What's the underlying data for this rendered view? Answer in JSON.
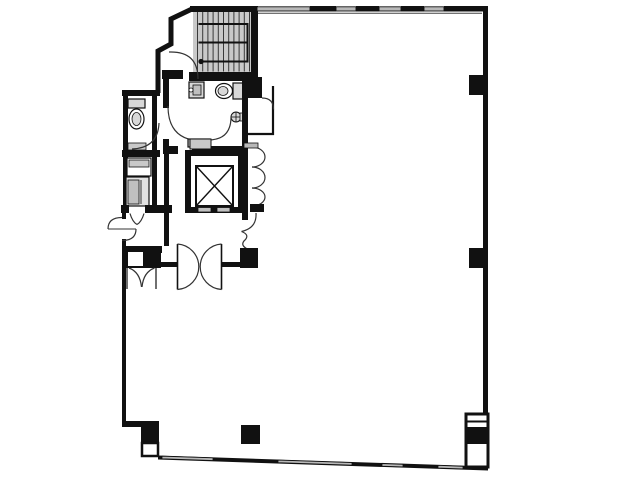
{
  "meta": {
    "type": "architectural-floor-plan",
    "canvas": {
      "width": 640,
      "height": 480
    }
  },
  "colors": {
    "wall": "#111111",
    "line": "#333333",
    "stair_fill": "#c9c9c9",
    "fixture": "#d8d8d8",
    "window": "#b8b8b8",
    "background": "#ffffff"
  },
  "plan": {
    "elements": [
      {
        "t": "rect",
        "n": "stairwell-fill",
        "x": 193,
        "y": 8,
        "w": 58,
        "h": 64,
        "f": "#c9c9c9"
      },
      {
        "t": "treads",
        "n": "stair-tread-line",
        "x0": 197.5,
        "x1": 249.5,
        "step": 5.2,
        "y0": 9,
        "y1": 71.5,
        "c": "#3a3a3a",
        "w": 1
      },
      {
        "t": "path",
        "n": "stair-flight-rail",
        "d": "M 198.5 24 H 247.5 V 61.5 H 198.5",
        "s": "#111111",
        "sw": 2
      },
      {
        "t": "line",
        "n": "stair-mid-rail",
        "x1": 198.5,
        "y1": 42.5,
        "x2": 247.5,
        "y2": 42.5,
        "s": "#111111",
        "sw": 2
      },
      {
        "t": "circle",
        "n": "stair-start-marker",
        "cx": 201,
        "cy": 61.5,
        "r": 2.6,
        "f": "#111111"
      },
      {
        "t": "rect",
        "n": "wing-top-wall",
        "x": 122,
        "y": 90,
        "w": 38,
        "h": 6
      },
      {
        "t": "rect",
        "n": "wing-left-wall",
        "x": 123,
        "y": 90,
        "w": 5,
        "h": 120
      },
      {
        "t": "rect",
        "n": "wing-right-wall",
        "x": 152,
        "y": 96,
        "w": 5,
        "h": 110
      },
      {
        "t": "rect",
        "n": "wing-divider-wall",
        "x": 122,
        "y": 150,
        "w": 38,
        "h": 7
      },
      {
        "t": "rect",
        "n": "wing-shelf",
        "x": 128,
        "y": 143,
        "w": 18,
        "h": 7,
        "f": "#c9c9c9",
        "s": "#111111",
        "sw": 0.8
      },
      {
        "t": "rect",
        "n": "wc-tank",
        "x": 128,
        "y": 99,
        "w": 17,
        "h": 9,
        "f": "#d8d8d8",
        "s": "#111111",
        "sw": 1.2
      },
      {
        "t": "ellipse",
        "n": "wc-bowl",
        "cx": 136.5,
        "cy": 119,
        "rx": 7.5,
        "ry": 10
      },
      {
        "t": "ellipse",
        "n": "wc-bowl-inner",
        "cx": 136.5,
        "cy": 119,
        "rx": 4.5,
        "ry": 6.5,
        "f": "#d8d8d8",
        "sw": 0.8
      },
      {
        "t": "path",
        "n": "wc-door-arc",
        "d": "M 132 149 Q 158 148 159 123"
      },
      {
        "t": "rect",
        "n": "duct-box-a",
        "x": 127,
        "y": 158,
        "w": 24,
        "h": 18,
        "f": "#ffffff",
        "s": "#111111",
        "sw": 1.2
      },
      {
        "t": "rect",
        "n": "duct-box-a-band",
        "x": 129,
        "y": 160,
        "w": 20,
        "h": 7,
        "f": "#c9c9c9",
        "s": "#111111",
        "sw": 0.8
      },
      {
        "t": "rect",
        "n": "duct-box-b",
        "x": 126,
        "y": 177,
        "w": 23,
        "h": 29,
        "f": "#e2e2e2",
        "s": "#111111",
        "sw": 1.2
      },
      {
        "t": "rect",
        "n": "duct-box-b-inner",
        "x": 128,
        "y": 180,
        "w": 11,
        "h": 24,
        "f": "#c0c0c0",
        "s": "#111111",
        "sw": 0.8
      },
      {
        "t": "line",
        "n": "duct-box-b-line",
        "x1": 141,
        "y1": 180,
        "x2": 141,
        "y2": 204,
        "s": "#333333",
        "sw": 1
      },
      {
        "t": "rect",
        "n": "wing-bottom-wall-left",
        "x": 121,
        "y": 205,
        "w": 8,
        "h": 8
      },
      {
        "t": "rect",
        "n": "wing-bottom-wall-right",
        "x": 145,
        "y": 205,
        "w": 27,
        "h": 8
      },
      {
        "t": "rect",
        "n": "left-wall-upper",
        "x": 122,
        "y": 210,
        "w": 4,
        "h": 9
      },
      {
        "t": "rect",
        "n": "left-wall-lower",
        "x": 122,
        "y": 239,
        "w": 4,
        "h": 186
      },
      {
        "t": "rect",
        "n": "bottom-step-wall",
        "x": 122,
        "y": 421,
        "w": 21,
        "h": 6
      },
      {
        "t": "rect",
        "n": "stair-top-wall",
        "x": 190,
        "y": 6,
        "w": 68,
        "h": 6
      },
      {
        "t": "rect",
        "n": "stair-right-wall",
        "x": 251,
        "y": 6,
        "w": 7,
        "h": 73
      },
      {
        "t": "rect",
        "n": "stair-bottom-wall-left",
        "x": 162,
        "y": 70,
        "w": 21,
        "h": 9
      },
      {
        "t": "rect",
        "n": "stair-bottom-wall-right",
        "x": 189,
        "y": 72,
        "w": 69,
        "h": 9
      },
      {
        "t": "path",
        "n": "northwest-boundary-wall",
        "d": "M 193 8.5 L 171 19 L 171 44 L 158 51 L 158 93",
        "s": "#111111",
        "sw": 5
      },
      {
        "t": "path",
        "n": "stair-door-arc",
        "d": "M 169 52 Q 198 51 198 79"
      },
      {
        "t": "rect",
        "n": "core-left-wall-upper",
        "x": 163,
        "y": 78,
        "w": 6,
        "h": 30
      },
      {
        "t": "rect",
        "n": "core-left-wall-mid",
        "x": 163,
        "y": 139,
        "w": 6,
        "h": 15
      },
      {
        "t": "rect",
        "n": "core-left-wall-lower",
        "x": 164,
        "y": 154,
        "w": 5,
        "h": 92
      },
      {
        "t": "rect",
        "n": "midwall-left",
        "x": 163,
        "y": 146,
        "w": 15,
        "h": 8
      },
      {
        "t": "rect",
        "n": "midwall-right",
        "x": 192,
        "y": 146,
        "w": 55,
        "h": 8
      },
      {
        "t": "rect",
        "n": "urinal-body",
        "x": 189,
        "y": 82,
        "w": 15,
        "h": 16,
        "f": "#d8d8d8",
        "s": "#111111",
        "sw": 1.2
      },
      {
        "t": "rect",
        "n": "urinal-inner",
        "x": 193,
        "y": 85,
        "w": 8,
        "h": 10,
        "f": "#bfbfbf",
        "s": "#111111",
        "sw": 0.8
      },
      {
        "t": "circle",
        "n": "urinal-knob",
        "cx": 191,
        "cy": 90,
        "r": 2,
        "f": "#ffffff",
        "s": "#111111",
        "sw": 0.8
      },
      {
        "t": "rect",
        "n": "toilet-tank",
        "x": 233,
        "y": 83,
        "w": 10,
        "h": 16,
        "f": "#d8d8d8",
        "s": "#111111",
        "sw": 1.2
      },
      {
        "t": "ellipse",
        "n": "toilet-bowl",
        "cx": 224,
        "cy": 91,
        "rx": 8.5,
        "ry": 7.5
      },
      {
        "t": "ellipse",
        "n": "toilet-bowl-inner",
        "cx": 223,
        "cy": 91,
        "rx": 5,
        "ry": 4.5,
        "f": "#d8d8d8",
        "sw": 0.8
      },
      {
        "t": "path",
        "n": "toilet-stall-door-arc",
        "d": "M 168 106 Q 168 141 203 141"
      },
      {
        "t": "circle",
        "n": "hand-sink",
        "cx": 236,
        "cy": 117,
        "r": 5,
        "f": "#d8d8d8",
        "s": "#111111",
        "sw": 1
      },
      {
        "t": "line",
        "n": "hand-sink-cross-h",
        "x1": 231.5,
        "y1": 117,
        "x2": 240.5,
        "y2": 117,
        "s": "#111111",
        "sw": 0.8
      },
      {
        "t": "line",
        "n": "hand-sink-cross-v",
        "x1": 236,
        "y1": 112.5,
        "x2": 236,
        "y2": 121.5,
        "s": "#111111",
        "sw": 0.8
      },
      {
        "t": "rect",
        "n": "hand-sink-mount",
        "x": 240,
        "y": 113,
        "w": 4.5,
        "h": 8,
        "f": "#d8d8d8",
        "s": "#111111",
        "sw": 0.8
      },
      {
        "t": "path",
        "n": "sink-area-door-arc",
        "d": "M 231 117 Q 231 140 208 140"
      },
      {
        "t": "rect",
        "n": "vanity-counter",
        "x": 188,
        "y": 139,
        "w": 22,
        "h": 8,
        "f": "#c9c9c9",
        "s": "#111111",
        "sw": 1.2
      },
      {
        "t": "line",
        "n": "vanity-divider",
        "x1": 199,
        "y1": 139,
        "x2": 199,
        "y2": 147,
        "s": "#111111",
        "sw": 0.8
      },
      {
        "t": "rect",
        "n": "elevator-shaft-wall",
        "x": 185,
        "y": 150,
        "w": 59,
        "h": 63
      },
      {
        "t": "rect",
        "n": "elevator-shaft-inner",
        "x": 191,
        "y": 156,
        "w": 47,
        "h": 51,
        "f": "#ffffff"
      },
      {
        "t": "rect",
        "n": "elevator-shelf",
        "x": 190,
        "y": 139,
        "w": 21,
        "h": 10,
        "f": "#c9c9c9",
        "s": "#111111",
        "sw": 1
      },
      {
        "t": "rect",
        "n": "elevator-cab-outline",
        "x": 196,
        "y": 166,
        "w": 37,
        "h": 40,
        "f": "none",
        "s": "#111111",
        "sw": 2
      },
      {
        "t": "line",
        "n": "elevator-x-1",
        "x1": 196.5,
        "y1": 166.5,
        "x2": 232.5,
        "y2": 205.5,
        "s": "#111111",
        "sw": 1.4
      },
      {
        "t": "line",
        "n": "elevator-x-2",
        "x1": 232.5,
        "y1": 166.5,
        "x2": 196.5,
        "y2": 205.5,
        "s": "#111111",
        "sw": 1.4
      },
      {
        "t": "rect",
        "n": "elevator-door-left",
        "x": 198,
        "y": 207.5,
        "w": 13,
        "h": 4.5,
        "f": "#c0c0c0",
        "s": "#111111",
        "sw": 0.8
      },
      {
        "t": "rect",
        "n": "elevator-door-right",
        "x": 217,
        "y": 207.5,
        "w": 13,
        "h": 4.5,
        "f": "#c0c0c0",
        "s": "#111111",
        "sw": 0.8
      },
      {
        "t": "rect",
        "n": "core-right-wall",
        "x": 242,
        "y": 95,
        "w": 6,
        "h": 125
      },
      {
        "t": "rect",
        "n": "column-core-ne",
        "x": 242,
        "y": 77,
        "w": 20,
        "h": 21
      },
      {
        "t": "line",
        "n": "closet-wall-v",
        "x1": 273,
        "y1": 86,
        "x2": 273,
        "y2": 135,
        "s": "#111111",
        "sw": 2.2
      },
      {
        "t": "line",
        "n": "closet-wall-h",
        "x1": 248,
        "y1": 134,
        "x2": 274,
        "y2": 134,
        "s": "#111111",
        "sw": 2.2
      },
      {
        "t": "path",
        "n": "closet-door-arc",
        "d": "M 262 98 Q 273.5 98 273.5 109.5"
      },
      {
        "t": "path",
        "n": "folding-door-1",
        "d": "M 252 147 A 13 10 0 0 1 252 167"
      },
      {
        "t": "path",
        "n": "folding-door-2",
        "d": "M 252 167 A 13 10.5 0 0 1 252 188"
      },
      {
        "t": "path",
        "n": "folding-door-3",
        "d": "M 252 188 A 13 9 0 0 1 252 206"
      },
      {
        "t": "rect",
        "n": "folding-door-stub-wall",
        "x": 250,
        "y": 204,
        "w": 14,
        "h": 8
      },
      {
        "t": "rect",
        "n": "window-sill-seg",
        "x": 244,
        "y": 143,
        "w": 14,
        "h": 5,
        "f": "#b8b8b8",
        "s": "#111111",
        "sw": 0.8
      },
      {
        "t": "path",
        "n": "lobby-door-arc",
        "d": "M 256 213 Q 257 228 241.5 231.5"
      },
      {
        "t": "path",
        "n": "opening-break-squiggle",
        "d": "M 241.5 231.5 q 8 3 4 8 q -6 5 1 9"
      },
      {
        "t": "rect",
        "n": "south-core-wall",
        "x": 124,
        "y": 246,
        "w": 38,
        "h": 7
      },
      {
        "t": "rect",
        "n": "south-wall-white-box",
        "x": 127,
        "y": 251,
        "w": 17,
        "h": 16,
        "f": "#ffffff",
        "s": "#111111",
        "sw": 2
      },
      {
        "t": "rect",
        "n": "column-core-sw",
        "x": 143,
        "y": 248,
        "w": 18,
        "h": 20
      },
      {
        "t": "line",
        "n": "closet-door-jamb-left",
        "x1": 127,
        "y1": 268,
        "x2": 127,
        "y2": 289,
        "s": "#111111",
        "sw": 1.2
      },
      {
        "t": "line",
        "n": "closet-door-jamb-right",
        "x1": 156,
        "y1": 268,
        "x2": 156,
        "y2": 289,
        "s": "#111111",
        "sw": 1.2
      },
      {
        "t": "path",
        "n": "double-closet-door-left",
        "d": "M 129 268 Q 140 272 141.5 287"
      },
      {
        "t": "path",
        "n": "double-closet-door-right",
        "d": "M 154.5 268 Q 143.5 272 142 287"
      },
      {
        "t": "rect",
        "n": "entry-wall-left",
        "x": 161,
        "y": 262,
        "w": 16,
        "h": 5
      },
      {
        "t": "line",
        "n": "entry-door-left-chord",
        "x1": 177.5,
        "y1": 244,
        "x2": 177.5,
        "y2": 289.5,
        "s": "#111111",
        "sw": 1.6
      },
      {
        "t": "path",
        "n": "entry-door-left-arc",
        "d": "M 177.5 244 A 22.8 22.8 0 0 1 177.5 289.5"
      },
      {
        "t": "line",
        "n": "entry-door-right-chord",
        "x1": 221.5,
        "y1": 244,
        "x2": 221.5,
        "y2": 289.5,
        "s": "#111111",
        "sw": 1.6
      },
      {
        "t": "path",
        "n": "entry-door-right-arc",
        "d": "M 221.5 244 A 22.8 22.8 0 0 0 221.5 289.5"
      },
      {
        "t": "rect",
        "n": "entry-wall-right",
        "x": 221,
        "y": 262,
        "w": 20,
        "h": 5
      },
      {
        "t": "rect",
        "n": "column-core-se",
        "x": 240,
        "y": 248,
        "w": 18,
        "h": 20
      },
      {
        "t": "path",
        "n": "balcony-door-arc-upper",
        "d": "M 122 217.5 Q 108 217.5 108 229"
      },
      {
        "t": "path",
        "n": "balcony-door-arc-lower",
        "d": "M 136 229 Q 136 240.5 122 240.5"
      },
      {
        "t": "line",
        "n": "balcony-door-leaf",
        "x1": 108,
        "y1": 229,
        "x2": 136,
        "y2": 229,
        "s": "#333333",
        "sw": 1.1
      },
      {
        "t": "path",
        "n": "service-door-arc-left",
        "d": "M 130 213.5 Q 132.5 222 137 224.5"
      },
      {
        "t": "path",
        "n": "service-door-arc-right",
        "d": "M 144 213.5 Q 141.5 222 137 224.5"
      },
      {
        "t": "line",
        "n": "north-window-inner-face",
        "x1": 258,
        "y1": 13.2,
        "x2": 482,
        "y2": 13.2,
        "s": "#444444",
        "sw": 1
      },
      {
        "t": "rect",
        "n": "north-window-1",
        "x": 257,
        "y": 6.8,
        "w": 53,
        "h": 4.2,
        "f": "#b8b8b8",
        "s": "#111111",
        "sw": 0.9
      },
      {
        "t": "rect",
        "n": "north-wall-seg-1",
        "x": 310,
        "y": 6,
        "w": 26,
        "h": 5.5
      },
      {
        "t": "rect",
        "n": "north-window-2",
        "x": 336,
        "y": 6.8,
        "w": 20,
        "h": 4.2,
        "f": "#b8b8b8",
        "s": "#111111",
        "sw": 0.9
      },
      {
        "t": "rect",
        "n": "north-wall-seg-2",
        "x": 356,
        "y": 6,
        "w": 23,
        "h": 5.5
      },
      {
        "t": "rect",
        "n": "north-window-3",
        "x": 379,
        "y": 6.8,
        "w": 22,
        "h": 4.2,
        "f": "#b8b8b8",
        "s": "#111111",
        "sw": 0.9
      },
      {
        "t": "rect",
        "n": "north-wall-seg-3",
        "x": 401,
        "y": 6,
        "w": 23,
        "h": 5.5
      },
      {
        "t": "rect",
        "n": "north-window-4",
        "x": 424,
        "y": 6.8,
        "w": 20,
        "h": 4.2,
        "f": "#b8b8b8",
        "s": "#111111",
        "sw": 0.9
      },
      {
        "t": "rect",
        "n": "north-wall-seg-4",
        "x": 444,
        "y": 6,
        "w": 44,
        "h": 5.5
      },
      {
        "t": "rect",
        "n": "east-wall",
        "x": 483,
        "y": 6,
        "w": 5,
        "h": 462
      },
      {
        "t": "rect",
        "n": "column-east-upper",
        "x": 469,
        "y": 75,
        "w": 17,
        "h": 20
      },
      {
        "t": "rect",
        "n": "column-east-mid",
        "x": 469,
        "y": 248,
        "w": 17,
        "h": 20
      },
      {
        "t": "path",
        "n": "south-wall-band",
        "d": "M 158 455.5 L 488 466.5 L 488 470.5 L 158 459.5 Z",
        "f": "#111111",
        "s": "none",
        "sw": 0
      },
      {
        "t": "path",
        "n": "south-window-1",
        "d": "M 162 456.2 L 213 457.9 L 213 460.5 L 162 458.8 Z",
        "f": "#b8b8b8",
        "s": "#111111",
        "sw": 0.8
      },
      {
        "t": "path",
        "n": "south-window-2",
        "d": "M 278 460.1 L 352 462.6 L 352 465.2 L 278 462.7 Z",
        "f": "#b8b8b8",
        "s": "#111111",
        "sw": 0.8
      },
      {
        "t": "path",
        "n": "south-window-3",
        "d": "M 382 463.6 L 403 464.3 L 403 466.9 L 382 466.2 Z",
        "f": "#b8b8b8",
        "s": "#111111",
        "sw": 0.8
      },
      {
        "t": "path",
        "n": "south-window-4",
        "d": "M 438 465.4 L 463 466.3 L 463 468.9 L 438 468.0 Z",
        "f": "#b8b8b8",
        "s": "#111111",
        "sw": 0.8
      },
      {
        "t": "rect",
        "n": "pier-southeast",
        "x": 466,
        "y": 414,
        "w": 22,
        "h": 53,
        "f": "#ffffff",
        "s": "#111111",
        "sw": 3
      },
      {
        "t": "line",
        "n": "pier-southeast-line",
        "x1": 466,
        "y1": 421.5,
        "x2": 488,
        "y2": 421.5,
        "s": "#111111",
        "sw": 2
      },
      {
        "t": "rect",
        "n": "column-southeast",
        "x": 467.5,
        "y": 427,
        "w": 19,
        "h": 17
      },
      {
        "t": "rect",
        "n": "column-southwest",
        "x": 141,
        "y": 421,
        "w": 18,
        "h": 23
      },
      {
        "t": "rect",
        "n": "corner-notch-box",
        "x": 142,
        "y": 443,
        "w": 16,
        "h": 13,
        "f": "#ffffff",
        "s": "#111111",
        "sw": 2.5
      },
      {
        "t": "rect",
        "n": "column-interior",
        "x": 241,
        "y": 425,
        "w": 19,
        "h": 19
      }
    ]
  }
}
